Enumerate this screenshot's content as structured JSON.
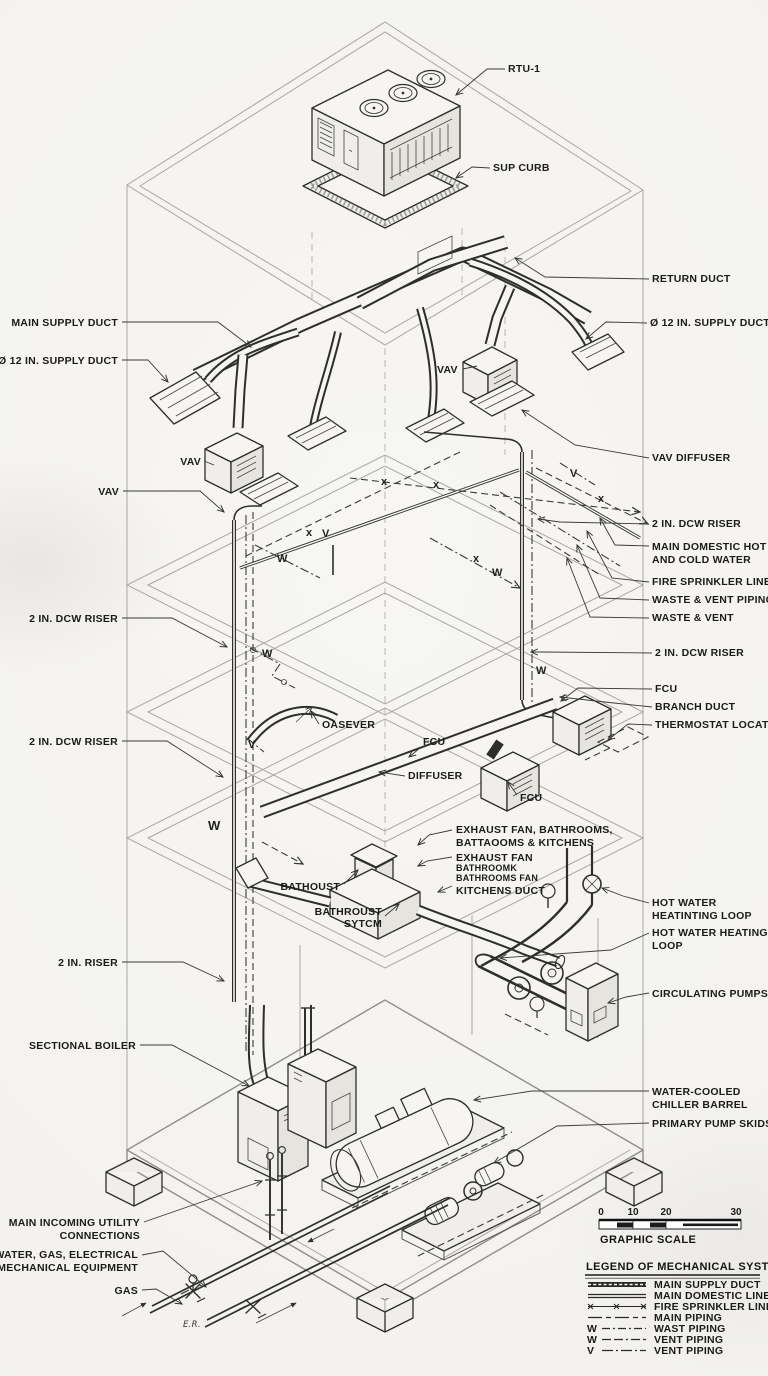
{
  "labels": {
    "rtu": "RTU-1",
    "sup_curb": "SUP CURB",
    "return_duct": "RETURN DUCT",
    "supply_duct_12_right": "Ø 12 IN. SUPPLY DUCT",
    "main_supply_duct": "MAIN SUPPLY DUCT",
    "supply_duct_12_left": "Ø 12 IN. SUPPLY DUCT",
    "vav_right": "VAV",
    "vav_left_1": "VAV",
    "vav_left_2": "VAV",
    "vav_diffuser": "VAV DIFFUSER",
    "dcw_riser_top_right": "2 IN. DCW RISER",
    "main_domestic_1": "MAIN DOMESTIC HOT",
    "main_domestic_2": "AND COLD WATER",
    "fire_sprinkler": "FIRE SPRINKLER LINES",
    "waste_vent_piping": "WASTE & VENT PIPING",
    "waste_vent": "WASTE & VENT",
    "dcw_riser_left_1": "2 IN. DCW RISER",
    "dcw_riser_right_2": "2 IN. DCW RISER",
    "dcw_riser_left_2": "2 IN. DCW RISER",
    "fcu_right": "FCU",
    "branch_duct": "BRANCH DUCT",
    "thermostat": "THERMOSTAT LOCATION",
    "oasever": "OASEVER",
    "fcu_mid": "FCU",
    "diffuser": "DIFFUSER",
    "fcu_low": "FCU",
    "exhaust1_1": "EXHAUST FAN, BATHROOMS,",
    "exhaust1_2": "BATTAOOMS & KITCHENS",
    "exhaust2_1": "EXHAUST FAN",
    "exhaust2_2": "BATHROOMK",
    "exhaust2_3": "BATHROOMS FAN",
    "bathoust": "BATHOUST",
    "kitchens_duct": "KITCHENS DUCT",
    "bathroust_1": "BATHROUST",
    "bathroust_2": "SYTCM",
    "hw_loop1_1": "HOT WATER",
    "hw_loop1_2": "HEATINTING LOOP",
    "hw_loop2_1": "HOT WATER HEATING",
    "hw_loop2_2": "LOOP",
    "circulating_pumps": "CIRCULATING PUMPS",
    "riser_2in": "2 IN. RISER",
    "sectional_boiler": "SECTIONAL BOILER",
    "chiller_1": "WATER-COOLED",
    "chiller_2": "CHILLER BARREL",
    "primary_pumps": "PRIMARY PUMP SKIDS",
    "utility_1": "MAIN INCOMING UTILITY",
    "utility_2": "CONNECTIONS",
    "water_gas_1": "WATER, GAS, ELECTRICAL",
    "water_gas_2": "FOR MECHANICAL EQUIPMENT",
    "gas": "GAS",
    "er": "E.R."
  },
  "markers": {
    "v": "V",
    "w": "W",
    "x": "x"
  },
  "scale": {
    "ticks": [
      "0",
      "10",
      "20",
      "30"
    ],
    "caption": "GRAPHIC SCALE"
  },
  "legend": {
    "title": "LEGEND OF MECHANICAL SYSTEMS",
    "items": [
      {
        "prefix": "",
        "label": "MAIN SUPPLY DUCT"
      },
      {
        "prefix": "",
        "label": "MAIN DOMESTIC LINES"
      },
      {
        "prefix": "",
        "label": "FIRE SPRINKLER LINES"
      },
      {
        "prefix": "",
        "label": "MAIN PIPING"
      },
      {
        "prefix": "W",
        "label": "WAST PIPING"
      },
      {
        "prefix": "W",
        "label": "VENT PIPING"
      },
      {
        "prefix": "V",
        "label": "VENT PIPING"
      }
    ]
  }
}
